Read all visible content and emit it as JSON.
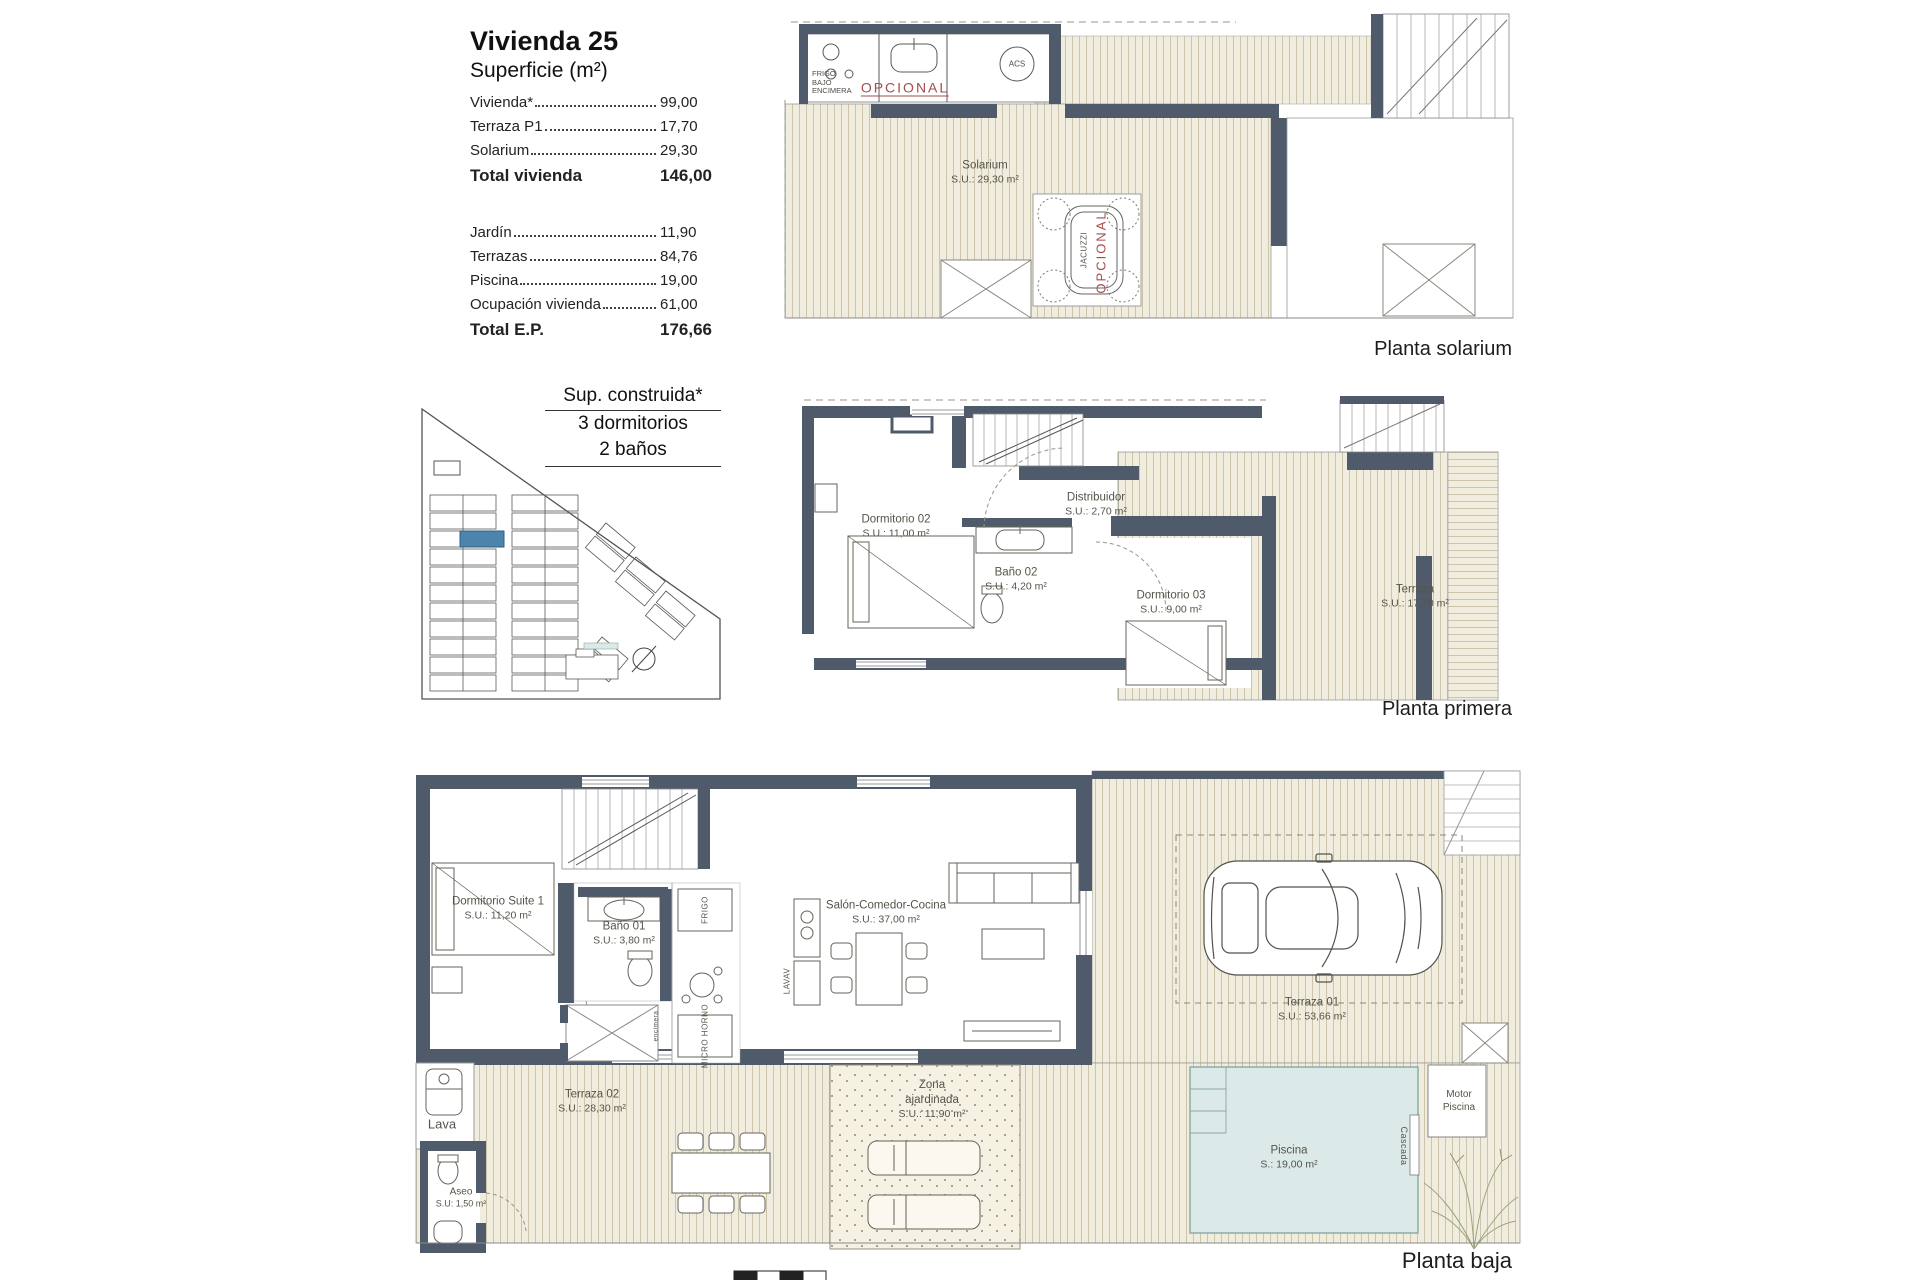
{
  "info": {
    "title": "Vivienda 25",
    "subtitle": "Superficie (m²)",
    "rows1": [
      {
        "label": "Vivienda*",
        "value": "99,00"
      },
      {
        "label": "Terraza P1",
        "value": "17,70"
      },
      {
        "label": "Solarium",
        "value": "29,30"
      }
    ],
    "total1": {
      "label": "Total vivienda",
      "value": "146,00"
    },
    "rows2": [
      {
        "label": "Jardín",
        "value": "11,90"
      },
      {
        "label": "Terrazas",
        "value": "84,76"
      },
      {
        "label": "Piscina",
        "value": "19,00"
      },
      {
        "label": "Ocupación vivienda",
        "value": "61,00"
      }
    ],
    "total2": {
      "label": "Total E.P.",
      "value": "176,66"
    },
    "built": {
      "title": "Sup. construida*",
      "bedrooms": "3 dormitorios",
      "baths": "2 baños"
    }
  },
  "plans": {
    "solarium": {
      "caption": "Planta solarium",
      "room_name": "Solarium",
      "room_area": "S.U.: 29,30 m²",
      "opcional": "OPCIONAL",
      "acs": "ACS",
      "frigo": [
        "FRIGO",
        "BAJO",
        "ENCIMERA"
      ],
      "jacuzzi": "JACUZZI",
      "jacuzzi_opt": "OPCIONAL"
    },
    "primera": {
      "caption": "Planta primera",
      "rooms": [
        {
          "name": "Dormitorio 02",
          "area": "S.U.: 11,00 m²"
        },
        {
          "name": "Baño 02",
          "area": "S.U.: 4,20 m²"
        },
        {
          "name": "Distribuidor",
          "area": "S.U.: 2,70 m²"
        },
        {
          "name": "Dormitorio 03",
          "area": "S.U.: 9,00 m²"
        },
        {
          "name": "Terraza",
          "area": "S.U.: 17,70 m²"
        }
      ]
    },
    "baja": {
      "caption": "Planta baja",
      "rooms": [
        {
          "name": "Dormitorio Suite 1",
          "area": "S.U.: 11,20 m²"
        },
        {
          "name": "Baño 01",
          "area": "S.U.: 3,80 m²"
        },
        {
          "name": "Salón-Comedor-Cocina",
          "area": "S.U.: 37,00 m²"
        },
        {
          "name": "Terraza 01",
          "area": "S.U.: 53,66 m²"
        },
        {
          "name": "Terraza 02",
          "area": "S.U.: 28,30 m²"
        },
        {
          "name": "Zona ajardinada",
          "area": "S.U.: 11,90 m²"
        },
        {
          "name": "Piscina",
          "area": "S.: 19,00 m²"
        },
        {
          "name": "Aseo",
          "area": "S.U: 1,50 m²"
        }
      ],
      "labels": {
        "lava": "Lava",
        "lavav": "LAVAV",
        "frigo": "FRIGO",
        "micro": "MICRO HORNO",
        "encimera": "encimera",
        "motor": "Motor Piscina",
        "cascada": "Cascada"
      }
    }
  },
  "colors": {
    "wall": "#4f5b6a",
    "deck_bg": "#f1edde",
    "deck_line": "#ccc5ac",
    "pool": "#dce9e9",
    "highlight_unit": "#4c84ad",
    "accent_red": "#a34d4d"
  }
}
